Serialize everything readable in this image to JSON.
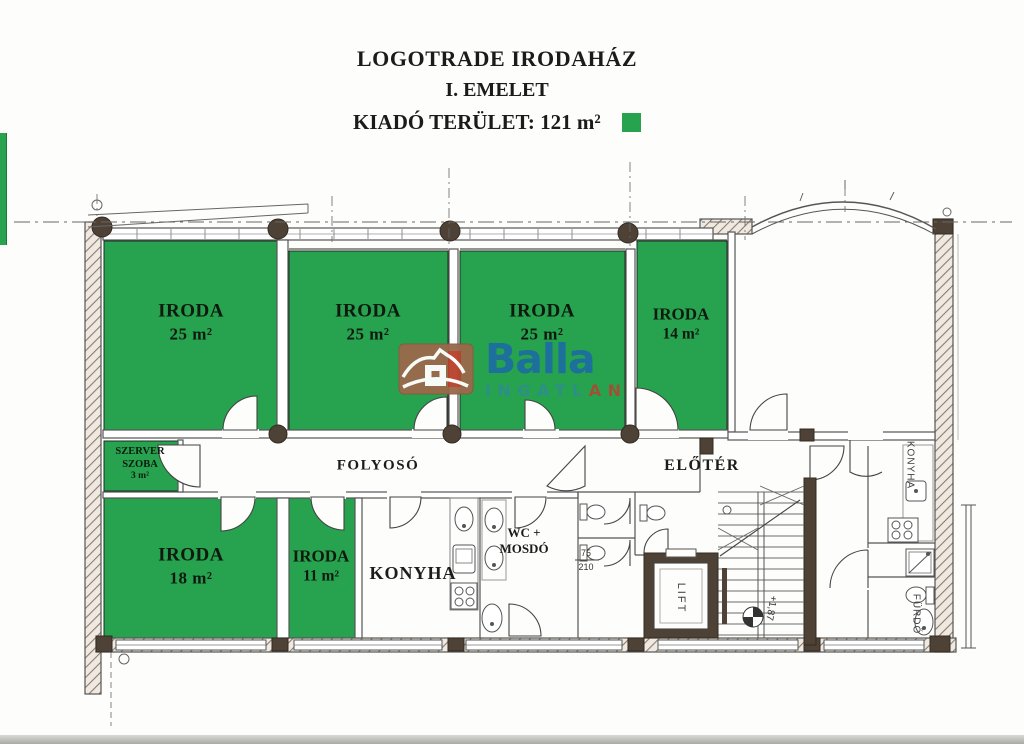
{
  "title": {
    "building": "LOGOTRADE IRODAHÁZ",
    "floor": "I. EMELET",
    "rentable_label": "KIADÓ TERÜLET:",
    "rentable_value": "121 m²"
  },
  "legend": {
    "highlight_color": "#27a24e"
  },
  "logo": {
    "brand": "Balla",
    "subbrand_left": "INGATL",
    "subbrand_right": "AN",
    "brand_color": "#1d6f9f",
    "subbrand_color_left": "#2f8e8d",
    "subbrand_color_right": "#a34f35",
    "house_color": "#9a6a4b"
  },
  "rooms": {
    "iroda_a": {
      "name": "IRODA",
      "area": "25 m²"
    },
    "iroda_b": {
      "name": "IRODA",
      "area": "25 m²"
    },
    "iroda_c": {
      "name": "IRODA",
      "area": "25 m²"
    },
    "iroda_d": {
      "name": "IRODA",
      "area": "14 m²"
    },
    "szerver": {
      "name_line1": "SZERVER",
      "name_line2": "SZOBA",
      "area": "3 m²"
    },
    "iroda_e": {
      "name": "IRODA",
      "area": "18 m²"
    },
    "iroda_f": {
      "name": "IRODA",
      "area": "11 m²"
    },
    "folyoso": {
      "name": "FOLYOSÓ"
    },
    "eloter": {
      "name": "ELŐTÉR"
    },
    "konyha": {
      "name": "KONYHA"
    },
    "wc": {
      "name_line1": "WC +",
      "name_line2": "MOSDÓ"
    },
    "lift": {
      "name": "LIFT"
    },
    "konyha_small": {
      "name": "KONYHA"
    },
    "furdo": {
      "name": "FÜRDŐ"
    }
  },
  "annotations": {
    "level_marker": "+1,87",
    "door_width": "75",
    "door_height": "210"
  }
}
